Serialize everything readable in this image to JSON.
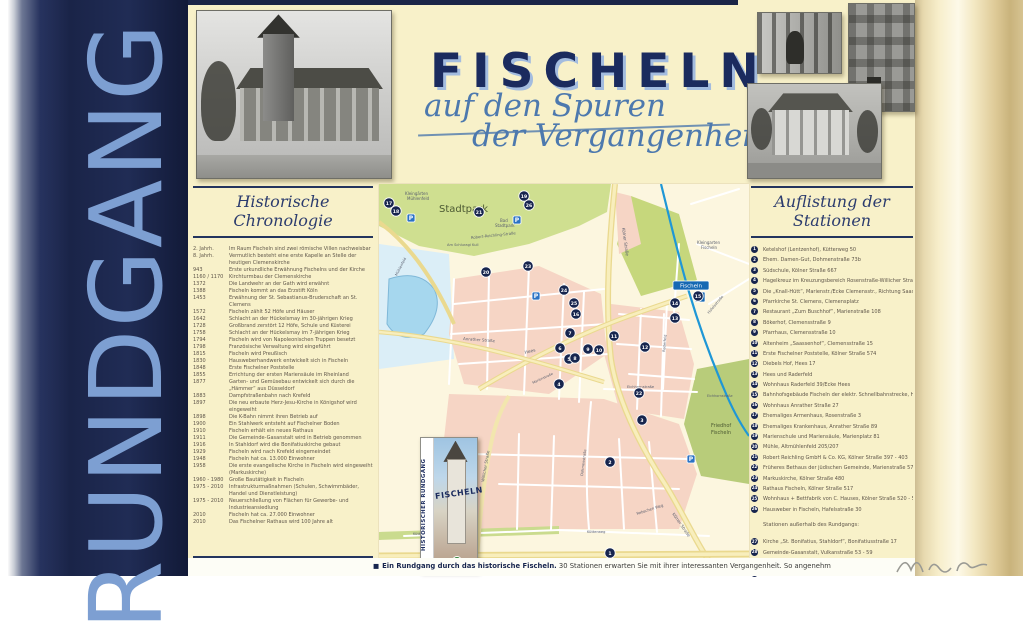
{
  "spine": {
    "text": "RUNDGANG"
  },
  "title": {
    "main": "FISCHELN",
    "sub1": "auf den Spuren",
    "sub2": "der Vergangenheit"
  },
  "chronology": {
    "heading": "Historische Chronologie",
    "entries": [
      {
        "year": "2. Jahrh.",
        "text": "Im Raum Fischeln sind zwei römische Villen nachweisbar"
      },
      {
        "year": "8. Jahrh.",
        "text": "Vermutlich besteht eine erste Kapelle an Stelle der heutigen Clemenskirche"
      },
      {
        "year": "943",
        "text": "Erste urkundliche Erwähnung Fischelns und der Kirche"
      },
      {
        "year": "1160 / 1170",
        "text": "Kirchturmbau der Clemenskirche"
      },
      {
        "year": "1372",
        "text": "Die Landwehr an der Gath wird erwähnt"
      },
      {
        "year": "1388",
        "text": "Fischeln kommt an das Erzstift Köln"
      },
      {
        "year": "1453",
        "text": "Erwähnung der St. Sebastianus-Bruderschaft an St. Clemens"
      },
      {
        "year": "1572",
        "text": "Fischeln zählt 52 Höfe und Häuser"
      },
      {
        "year": "1642",
        "text": "Schlacht an der Hückelsmay im 30-jährigen Krieg"
      },
      {
        "year": "1728",
        "text": "Großbrand zerstört 12 Höfe, Schule und Küsterei"
      },
      {
        "year": "1758",
        "text": "Schlacht an der Hückelsmay im 7-jährigen Krieg"
      },
      {
        "year": "1794",
        "text": "Fischeln wird von Napoleonischen Truppen besetzt"
      },
      {
        "year": "1798",
        "text": "Französische Verwaltung wird eingeführt"
      },
      {
        "year": "1815",
        "text": "Fischeln wird Preußisch"
      },
      {
        "year": "1830",
        "text": "Hausweberhandwerk entwickelt sich in Fischeln"
      },
      {
        "year": "1848",
        "text": "Erste Fischelner Poststelle"
      },
      {
        "year": "1855",
        "text": "Errichtung der ersten Mariensäule im Rheinland"
      },
      {
        "year": "1877",
        "text": "Garten- und Gemüsebau entwickelt sich durch die „Hämmer“ aus Düsseldorf"
      },
      {
        "year": "1883",
        "text": "Dampfstraßenbahn nach Krefeld"
      },
      {
        "year": "1897",
        "text": "Die neu erbaute Herz-Jesu-Kirche in Königshof wird eingeweiht"
      },
      {
        "year": "1898",
        "text": "Die K-Bahn nimmt ihren Betrieb auf"
      },
      {
        "year": "1900",
        "text": "Ein Stahlwerk entsteht auf Fischelner Boden"
      },
      {
        "year": "1910",
        "text": "Fischeln erhält ein neues Rathaus"
      },
      {
        "year": "1911",
        "text": "Die Gemeinde-Gasanstalt wird in Betrieb genommen"
      },
      {
        "year": "1916",
        "text": "In Stahldorf wird die Bonifatiuskirche gebaut"
      },
      {
        "year": "1929",
        "text": "Fischeln wird nach Krefeld eingemeindet"
      },
      {
        "year": "1948",
        "text": "Fischeln hat ca. 13.000 Einwohner"
      },
      {
        "year": "1958",
        "text": "Die erste evangelische Kirche in Fischeln wird eingeweiht (Markuskirche)"
      },
      {
        "year": "1960 - 1980",
        "text": "Große Bautätigkeit in Fischeln"
      },
      {
        "year": "1975 - 2010",
        "text": "Infrastrukturmaßnahmen (Schulen, Schwimmbäder, Handel und Dienstleistung)"
      },
      {
        "year": "1975 - 2010",
        "text": "Neuerschließung von Flächen für Gewerbe- und Industrieansiedlung"
      },
      {
        "year": "2010",
        "text": "Fischeln hat ca. 27.000 Einwohner"
      },
      {
        "year": "2010",
        "text": "Das Fischelner Rathaus wird 100 Jahre alt"
      }
    ]
  },
  "stations": {
    "heading": "Auflistung der Stationen",
    "items": [
      {
        "num": "1",
        "text": "Ketelshof (Lentzenhof), Kütterweg 50"
      },
      {
        "num": "2",
        "text": "Ehem. Damen-Gut, Dohmenstraße 73b"
      },
      {
        "num": "3",
        "text": "Südschule, Kölner Straße 667"
      },
      {
        "num": "4",
        "text": "Hagelkreuz im Kreuzungsbereich Rosenstraße-Willicher Straße"
      },
      {
        "num": "5",
        "text": "Die „Knall-Hütt“, Marienstr./Ecke Clemensstr., Richtung Saassenstraße"
      },
      {
        "num": "6",
        "text": "Pfarrkirche St. Clemens, Clemensplatz"
      },
      {
        "num": "7",
        "text": "Restaurant „Zum Buschhof“, Marienstraße 108"
      },
      {
        "num": "8",
        "text": "Bökerhof, Clemensstraße 9"
      },
      {
        "num": "9",
        "text": "Pfarrhaus, Clemensstraße 10"
      },
      {
        "num": "10",
        "text": "Altenheim „Saassenhof“, Clemensstraße 15"
      },
      {
        "num": "11",
        "text": "Erste Fischelner Poststelle, Kölner Straße 574"
      },
      {
        "num": "12",
        "text": "Diebels Hof, Hees 17"
      },
      {
        "num": "13",
        "text": "Hees und Raderfeld"
      },
      {
        "num": "14",
        "text": "Wohnhaus Raderfeld 39/Ecke Hees"
      },
      {
        "num": "15",
        "text": "Bahnhofsgebäude Fischeln der elektr. Schnellbahnstrecke, Hees 84"
      },
      {
        "num": "16",
        "text": "Wohnhaus Anrather Straße 27"
      },
      {
        "num": "17",
        "text": "Ehemaliges Armenhaus, Rosenstraße 3"
      },
      {
        "num": "18",
        "text": "Ehemaliges Krankenhaus, Anrather Straße 89"
      },
      {
        "num": "19",
        "text": "Marienschule und Mariensäule, Marienplatz 81"
      },
      {
        "num": "20",
        "text": "Mühle, Altmühlenfeld 205/207"
      },
      {
        "num": "21",
        "text": "Robert Reichling GmbH & Co. KG, Kölner Straße 397 - 403"
      },
      {
        "num": "22",
        "text": "Früheres Bethaus der jüdischen Gemeinde, Marienstraße 57"
      },
      {
        "num": "23",
        "text": "Markuskirche, Kölner Straße 480"
      },
      {
        "num": "24",
        "text": "Rathaus Fischeln, Kölner Straße 517"
      },
      {
        "num": "25",
        "text": "Wohnhaus + Bettfabrik von C. Hauses, Kölner Straße 520 - 525"
      },
      {
        "num": "26",
        "text": "Hausweber in Fischeln, Hafelsstraße 30"
      }
    ],
    "outside_note": "Stationen außerhalb des Rundgangs:",
    "outside_items": [
      {
        "num": "27",
        "text": "Kirche „St. Bonifatius, Stahldorf“, Bonifatiusstraße 17"
      },
      {
        "num": "28",
        "text": "Gemeinde-Gasanstalt, Vulkanstraße 53 - 59"
      },
      {
        "num": "29",
        "text": "Gasthof Korff „Zum Königshof“, Kölner Straße 252 - 256"
      },
      {
        "num": "30",
        "text": "Herz-Jesu-Kirche Königshof, Kreinstraße 64"
      }
    ]
  },
  "map": {
    "station_sign": {
      "name": "Fischeln",
      "logo": "U"
    },
    "brochure": {
      "vertical": "HISTORISCHER RUNDGANG",
      "title": "FISCHELN"
    },
    "labels": [
      {
        "t": "Stadtpark",
        "x": 60,
        "y": 28,
        "s": 10,
        "c": "#4c5a33"
      },
      {
        "t": "Kleingärten",
        "x": 26,
        "y": 11,
        "s": 4
      },
      {
        "t": "Mühlenfeld",
        "x": 28,
        "y": 16,
        "s": 4
      },
      {
        "t": "Bad",
        "x": 121,
        "y": 38,
        "s": 4
      },
      {
        "t": "Stadtpark",
        "x": 116,
        "y": 43,
        "s": 4
      },
      {
        "t": "Am Schluragi Kull",
        "x": 68,
        "y": 62,
        "s": 3.6
      },
      {
        "t": "Robert-Reichling-Straße",
        "x": 92,
        "y": 55,
        "s": 3.8,
        "r": -6
      },
      {
        "t": "Kölner Straße",
        "x": 243,
        "y": 44,
        "s": 4.2,
        "r": 82
      },
      {
        "t": "Kölner Straße",
        "x": 293,
        "y": 330,
        "s": 4.2,
        "r": 55
      },
      {
        "t": "Hees",
        "x": 146,
        "y": 170,
        "s": 4.4,
        "r": -14
      },
      {
        "t": "Hees",
        "x": 293,
        "y": 122,
        "s": 3.6,
        "r": -12
      },
      {
        "t": "Anrather Straße",
        "x": 84,
        "y": 156,
        "s": 4,
        "r": 4
      },
      {
        "t": "Willicher Straße",
        "x": 105,
        "y": 298,
        "s": 4,
        "r": -80
      },
      {
        "t": "Kütterweg",
        "x": 34,
        "y": 351,
        "s": 3.6
      },
      {
        "t": "Kütterweg",
        "x": 208,
        "y": 349,
        "s": 3.6
      },
      {
        "t": "Eichhornstraße",
        "x": 248,
        "y": 204,
        "s": 3.6
      },
      {
        "t": "Eichhornstraße",
        "x": 328,
        "y": 213,
        "s": 3.4
      },
      {
        "t": "Dohmenstraße",
        "x": 204,
        "y": 292,
        "s": 3.6,
        "r": -83
      },
      {
        "t": "Raderfeld",
        "x": 286,
        "y": 168,
        "s": 3.6,
        "r": -85
      },
      {
        "t": "Hafelsstraße",
        "x": 330,
        "y": 130,
        "s": 3.6,
        "r": -50
      },
      {
        "t": "Marienstraße",
        "x": 154,
        "y": 200,
        "s": 3.4,
        "r": -25
      },
      {
        "t": "Rebschen Weg",
        "x": 258,
        "y": 331,
        "s": 3.8,
        "r": -18
      },
      {
        "t": "Mühlenfeld",
        "x": 18,
        "y": 92,
        "s": 3.6,
        "r": -62
      },
      {
        "t": "Kleingarten",
        "x": 318,
        "y": 60,
        "s": 4
      },
      {
        "t": "Fischeln",
        "x": 322,
        "y": 65,
        "s": 4
      },
      {
        "t": "Friedhof",
        "x": 332,
        "y": 243,
        "s": 5,
        "c": "#4c5a33"
      },
      {
        "t": "Fischeln",
        "x": 332,
        "y": 250,
        "s": 5,
        "c": "#4c5a33"
      }
    ],
    "markers": [
      {
        "n": "1",
        "x": 231,
        "y": 369
      },
      {
        "n": "2",
        "x": 231,
        "y": 278
      },
      {
        "n": "3",
        "x": 263,
        "y": 236
      },
      {
        "n": "4",
        "x": 180,
        "y": 200
      },
      {
        "n": "5",
        "x": 190,
        "y": 175
      },
      {
        "n": "6",
        "x": 181,
        "y": 164
      },
      {
        "n": "7",
        "x": 191,
        "y": 149
      },
      {
        "n": "8",
        "x": 196,
        "y": 174
      },
      {
        "n": "9",
        "x": 209,
        "y": 165
      },
      {
        "n": "10",
        "x": 220,
        "y": 166
      },
      {
        "n": "11",
        "x": 235,
        "y": 152
      },
      {
        "n": "12",
        "x": 266,
        "y": 163
      },
      {
        "n": "13",
        "x": 296,
        "y": 134
      },
      {
        "n": "14",
        "x": 296,
        "y": 119
      },
      {
        "n": "15",
        "x": 319,
        "y": 112
      },
      {
        "n": "16",
        "x": 197,
        "y": 130
      },
      {
        "n": "17",
        "x": 10,
        "y": 19
      },
      {
        "n": "18",
        "x": 17,
        "y": 27
      },
      {
        "n": "19",
        "x": 145,
        "y": 12
      },
      {
        "n": "20",
        "x": 107,
        "y": 88
      },
      {
        "n": "21",
        "x": 100,
        "y": 28
      },
      {
        "n": "22",
        "x": 260,
        "y": 209
      },
      {
        "n": "23",
        "x": 149,
        "y": 82
      },
      {
        "n": "24",
        "x": 185,
        "y": 106
      },
      {
        "n": "25",
        "x": 195,
        "y": 119
      },
      {
        "n": "26",
        "x": 150,
        "y": 21
      }
    ],
    "parking": [
      {
        "x": 32,
        "y": 34
      },
      {
        "x": 138,
        "y": 36
      },
      {
        "x": 157,
        "y": 112
      },
      {
        "x": 312,
        "y": 275
      }
    ]
  },
  "footer": {
    "bullet": "■",
    "lead": "Ein Rundgang durch das historische Fischeln.",
    "rest": " 30 Stationen erwarten Sie mit ihrer interessanten Vergangenheit. So angenehm"
  },
  "colors": {
    "navy": "#1b2b5e",
    "script_blue": "#4d79ae",
    "board_cream": "#f8f1c9",
    "map_pink": "#f6d5c5",
    "map_green": "#cfdf90",
    "map_water": "#a6d7ee",
    "map_road": "#ead98f",
    "rail_blue": "#1f97d6",
    "badge_navy": "#17254e"
  }
}
